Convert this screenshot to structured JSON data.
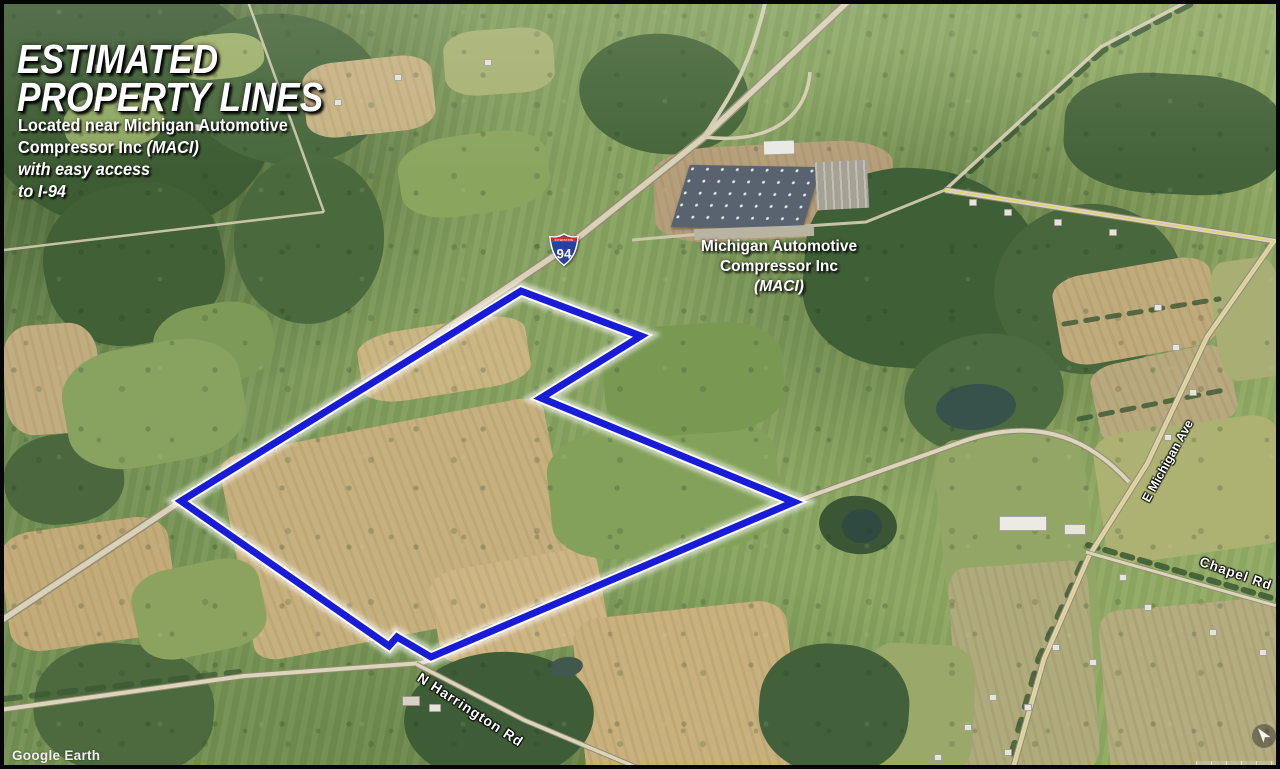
{
  "header": {
    "title_line1": "ESTIMATED",
    "title_line2": "PROPERTY LINES",
    "subtitle": {
      "line1": "Located near Michigan Automotive",
      "line2_normal": "Compressor Inc ",
      "line2_italic": "(MACI)",
      "line3": "with easy access",
      "line4": "to I-94"
    }
  },
  "map": {
    "facility_label": {
      "line1": "Michigan Automotive",
      "line2": "Compressor Inc",
      "line3": "(MACI)"
    },
    "road_labels": {
      "michigan_ave": "E Michigan Ave",
      "chapel_rd": "Chapel Rd",
      "harrington_rd": "N Harrington Rd"
    },
    "highway_shield": {
      "top": "INTERSTATE",
      "number": "94"
    },
    "watermark": "Google Earth",
    "property_line": {
      "stroke_color": "#181bd8",
      "casing_color": "#ffffff",
      "points": [
        [
          517,
          287
        ],
        [
          637,
          332
        ],
        [
          537,
          394
        ],
        [
          790,
          498
        ],
        [
          427,
          653
        ],
        [
          393,
          633
        ],
        [
          385,
          642
        ],
        [
          177,
          497
        ]
      ]
    }
  }
}
